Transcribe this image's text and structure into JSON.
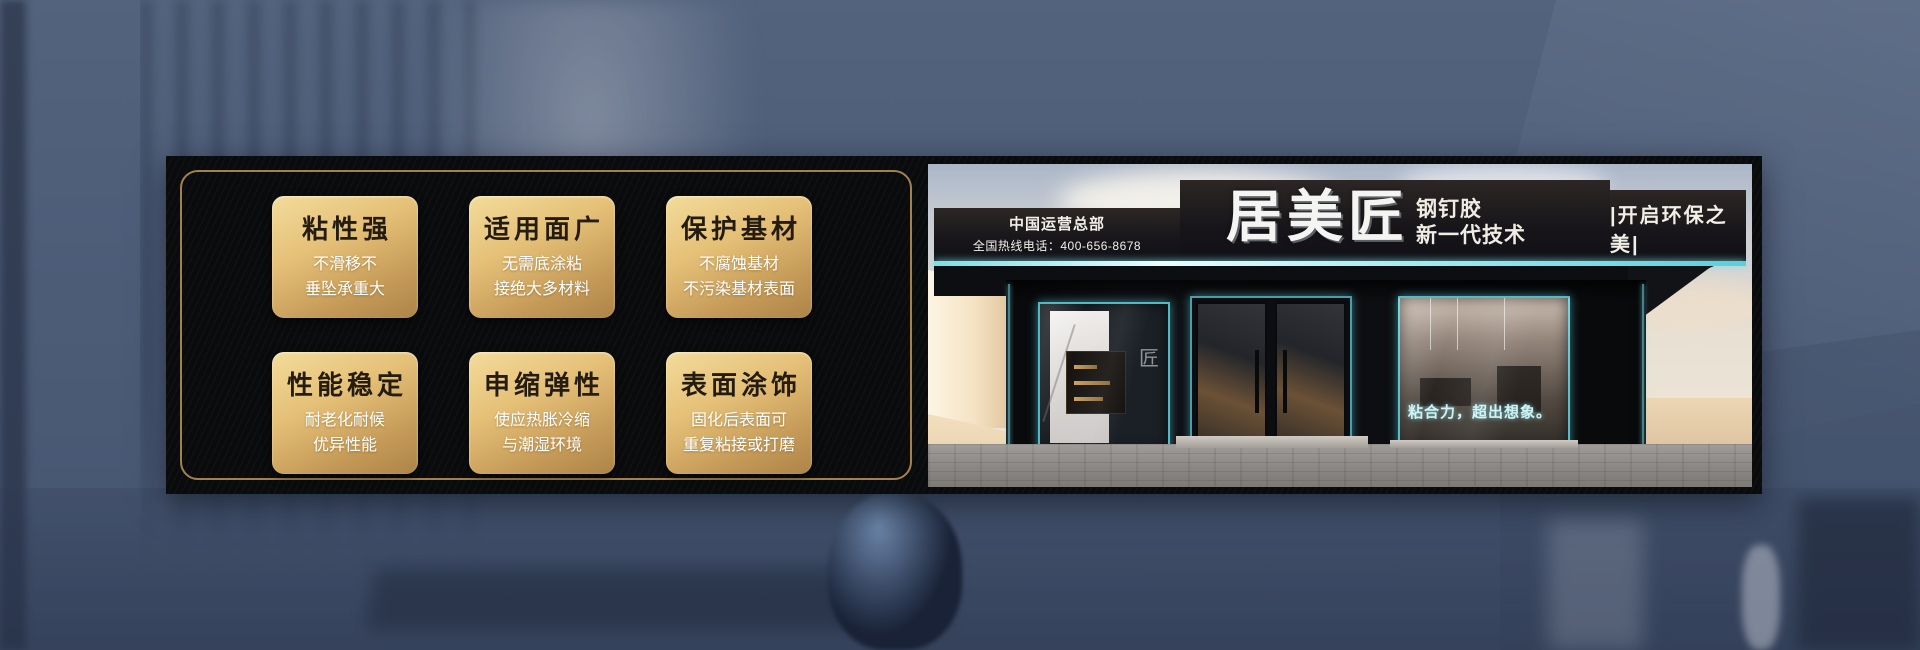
{
  "colors": {
    "background_blue": "#4e5d78",
    "banner_black": "#0a0b0d",
    "gold_border": "#bb9459",
    "card_gold_light": "#f3dc9b",
    "card_gold_dark": "#ad8448",
    "card_title_brown": "#241c10",
    "card_body_white": "#ffffff",
    "teal_accent": "#6fe0ee",
    "sign_black": "#15141a"
  },
  "features": {
    "cards": [
      {
        "title": "粘性强",
        "line1": "不滑移不",
        "line2": "垂坠承重大"
      },
      {
        "title": "适用面广",
        "line1": "无需底涂粘",
        "line2": "接绝大多材料"
      },
      {
        "title": "保护基材",
        "line1": "不腐蚀基材",
        "line2": "不污染基材表面"
      },
      {
        "title": "性能稳定",
        "line1": "耐老化耐候",
        "line2": "优异性能"
      },
      {
        "title": "申缩弹性",
        "line1": "使应热胀冷缩",
        "line2": "与潮湿环境"
      },
      {
        "title": "表面涂饰",
        "line1": "固化后表面可",
        "line2": "重复粘接或打磨"
      }
    ]
  },
  "storefront": {
    "hq_label": "中国运营总部",
    "hotline": "全国热线电话：400-656-8678",
    "brand": "居美匠",
    "product": "钢钉胶",
    "tech": "新一代技术",
    "eco_slogan": "|开启环保之美|",
    "window_slogan": "粘合力，超出想象。",
    "window_logo": "匠"
  }
}
